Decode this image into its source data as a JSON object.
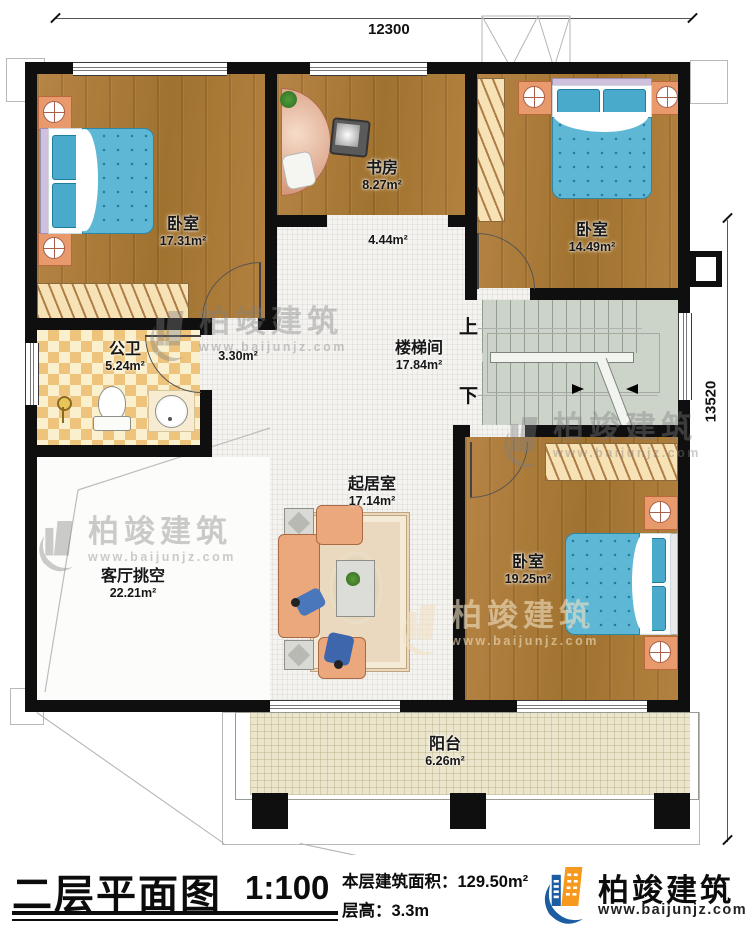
{
  "dimensions": {
    "top": "12300",
    "right": "13520"
  },
  "rooms": {
    "bedroom1": {
      "name": "卧室",
      "area": "17.31m²"
    },
    "study": {
      "name": "书房",
      "area": "8.27m²"
    },
    "bedroom2": {
      "name": "卧室",
      "area": "14.49m²"
    },
    "hall": {
      "area": "4.44m²"
    },
    "bathroom": {
      "name": "公卫",
      "area": "5.24m²"
    },
    "corridor": {
      "area": "3.30m²"
    },
    "stairwell": {
      "name": "楼梯间",
      "area": "17.84m²",
      "up": "上",
      "down": "下"
    },
    "living": {
      "name": "起居室",
      "area": "17.14m²"
    },
    "bedroom3": {
      "name": "卧室",
      "area": "19.25m²"
    },
    "void": {
      "name": "客厅挑空",
      "area": "22.21m²"
    },
    "balcony": {
      "name": "阳台",
      "area": "6.26m²"
    }
  },
  "watermark": {
    "brand": "柏竣建筑",
    "url": "www.baijunjz.com"
  },
  "titleblock": {
    "title": "二层平面图",
    "scale": "1:100",
    "area_label": "本层建筑面积：",
    "area_value": "129.50m²",
    "floor_height_label": "层高：",
    "floor_height_value": "3.3m",
    "brand": "柏竣建筑",
    "brand_url": "www.baijunjz.com"
  }
}
